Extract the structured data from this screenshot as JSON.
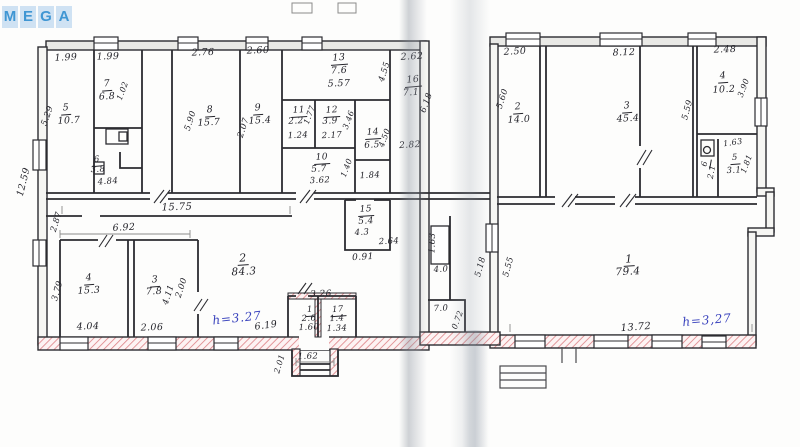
{
  "watermark": {
    "letters": [
      "M",
      "E",
      "G",
      "A"
    ],
    "tile_color": "#cfe2f3",
    "letter_color": "#3f96d3"
  },
  "plan": {
    "ink_color": "#24242b",
    "blue_ink": "#3a43bd",
    "hatch_color": "#dc8084",
    "labels": [
      {
        "id": "dim-199-a",
        "t": "1.99",
        "x": 66,
        "y": 58,
        "r": -3
      },
      {
        "id": "dim-199-b",
        "t": "1.99",
        "x": 108,
        "y": 57,
        "r": -2
      },
      {
        "id": "dim-276",
        "t": "2.76",
        "x": 203,
        "y": 53,
        "r": -2
      },
      {
        "id": "dim-260",
        "t": "2.60",
        "x": 258,
        "y": 51,
        "r": -2
      },
      {
        "id": "room13-num",
        "t": "13",
        "x": 339,
        "y": 59,
        "u": true,
        "r": -4
      },
      {
        "id": "room13-area",
        "t": "7.6",
        "x": 339,
        "y": 71,
        "r": -3
      },
      {
        "id": "dim-557",
        "t": "5.57",
        "x": 339,
        "y": 84,
        "r": -2
      },
      {
        "id": "dim-455",
        "t": "4.55",
        "x": 385,
        "y": 72,
        "r": -72,
        "s": 8.5
      },
      {
        "id": "dim-262",
        "t": "2.62",
        "x": 412,
        "y": 57,
        "r": -3
      },
      {
        "id": "room16-num",
        "t": "16",
        "x": 413,
        "y": 81,
        "u": true,
        "r": -5
      },
      {
        "id": "room16-area",
        "t": "7.1",
        "x": 411,
        "y": 93,
        "r": -3
      },
      {
        "id": "dim-618",
        "t": "6.18",
        "x": 427,
        "y": 103,
        "r": -70,
        "s": 8.5
      },
      {
        "id": "dim-1259",
        "t": "12.59",
        "x": 24,
        "y": 182,
        "r": -76
      },
      {
        "id": "dim-529",
        "t": "5.29",
        "x": 48,
        "y": 116,
        "r": -70,
        "s": 8.5
      },
      {
        "id": "room5-num",
        "t": "5",
        "x": 66,
        "y": 109,
        "u": true,
        "r": -4
      },
      {
        "id": "room5-area",
        "t": "10.7",
        "x": 69,
        "y": 121,
        "r": -3
      },
      {
        "id": "room7-num",
        "t": "7",
        "x": 107,
        "y": 85,
        "u": true,
        "r": -4
      },
      {
        "id": "room7-area",
        "t": "6.8",
        "x": 107,
        "y": 97,
        "r": -3
      },
      {
        "id": "dim-102",
        "t": "1.02",
        "x": 123,
        "y": 91,
        "r": -70,
        "s": 8
      },
      {
        "id": "room6-num",
        "t": "6",
        "x": 97,
        "y": 161,
        "u": true,
        "s": 8.5,
        "r": -5
      },
      {
        "id": "room6-area",
        "t": "3.8",
        "x": 98,
        "y": 170,
        "s": 8.5,
        "r": -3
      },
      {
        "id": "dim-484",
        "t": "4.84",
        "x": 108,
        "y": 182,
        "s": 8.5,
        "r": -4
      },
      {
        "id": "room8-num",
        "t": "8",
        "x": 210,
        "y": 111,
        "u": true,
        "r": -4
      },
      {
        "id": "room8-area",
        "t": "15.7",
        "x": 209,
        "y": 123,
        "r": -3
      },
      {
        "id": "dim-590",
        "t": "5.90",
        "x": 191,
        "y": 121,
        "r": -72,
        "s": 8.5
      },
      {
        "id": "room9-num",
        "t": "9",
        "x": 258,
        "y": 109,
        "u": true,
        "r": -4
      },
      {
        "id": "room9-area",
        "t": "15.4",
        "x": 260,
        "y": 121,
        "r": -3
      },
      {
        "id": "dim-207",
        "t": "2.07",
        "x": 244,
        "y": 128,
        "r": -72,
        "s": 8.5
      },
      {
        "id": "room11-num",
        "t": "11",
        "x": 299,
        "y": 112,
        "u": true,
        "s": 9,
        "r": -4
      },
      {
        "id": "room11-area",
        "t": "2.2",
        "x": 296,
        "y": 122,
        "s": 9,
        "r": -3
      },
      {
        "id": "dim-124",
        "t": "1.24",
        "x": 298,
        "y": 136,
        "s": 8.5,
        "r": -3
      },
      {
        "id": "dim-177",
        "t": "1.77",
        "x": 310,
        "y": 115,
        "r": -70,
        "s": 8
      },
      {
        "id": "room12-num",
        "t": "12",
        "x": 332,
        "y": 112,
        "u": true,
        "s": 9,
        "r": -4
      },
      {
        "id": "room12-area",
        "t": "3.9",
        "x": 330,
        "y": 122,
        "s": 9,
        "r": -3
      },
      {
        "id": "dim-217",
        "t": "2.17",
        "x": 332,
        "y": 136,
        "s": 8.5,
        "r": -3
      },
      {
        "id": "dim-346",
        "t": "3.46",
        "x": 349,
        "y": 120,
        "r": -70,
        "s": 8
      },
      {
        "id": "room14-num",
        "t": "14",
        "x": 373,
        "y": 134,
        "u": true,
        "s": 9,
        "r": -4
      },
      {
        "id": "room14-area",
        "t": "6.5",
        "x": 372,
        "y": 146,
        "s": 9,
        "r": -3
      },
      {
        "id": "dim-450",
        "t": "4.50",
        "x": 385,
        "y": 138,
        "r": -70,
        "s": 8
      },
      {
        "id": "room10-num",
        "t": "10",
        "x": 322,
        "y": 159,
        "u": true,
        "s": 9,
        "r": -4
      },
      {
        "id": "room10-area",
        "t": "5.7",
        "x": 319,
        "y": 170,
        "s": 9,
        "r": -3
      },
      {
        "id": "dim-362",
        "t": "3.62",
        "x": 320,
        "y": 181,
        "s": 8.5,
        "r": -3
      },
      {
        "id": "dim-140",
        "t": "1.40",
        "x": 347,
        "y": 168,
        "r": -70,
        "s": 8
      },
      {
        "id": "dim-184",
        "t": "1.84",
        "x": 370,
        "y": 176,
        "s": 8.5,
        "r": -3
      },
      {
        "id": "dim-282",
        "t": "2.82",
        "x": 410,
        "y": 146,
        "s": 9,
        "r": -3
      },
      {
        "id": "room15-num",
        "t": "15",
        "x": 366,
        "y": 211,
        "u": true,
        "s": 9,
        "r": -4
      },
      {
        "id": "room15-area",
        "t": "5.4",
        "x": 366,
        "y": 222,
        "s": 9,
        "r": -3
      },
      {
        "id": "dim-43",
        "t": "4.3",
        "x": 362,
        "y": 233,
        "s": 8.5,
        "r": -3
      },
      {
        "id": "dim-264",
        "t": "2.64",
        "x": 389,
        "y": 242,
        "s": 8.5,
        "r": -3
      },
      {
        "id": "dim-091",
        "t": "0.91",
        "x": 363,
        "y": 258,
        "s": 9,
        "r": -3
      },
      {
        "id": "dim-1575",
        "t": "15.75",
        "x": 177,
        "y": 208,
        "s": 10,
        "r": -2
      },
      {
        "id": "dim-287",
        "t": "2.87",
        "x": 57,
        "y": 222,
        "r": -73,
        "s": 8.5
      },
      {
        "id": "dim-692",
        "t": "6.92",
        "x": 124,
        "y": 228,
        "s": 9.5,
        "r": -3
      },
      {
        "id": "room4-num",
        "t": "4",
        "x": 89,
        "y": 279,
        "u": true,
        "r": -4
      },
      {
        "id": "room4-area",
        "t": "15.3",
        "x": 89,
        "y": 291,
        "r": -3
      },
      {
        "id": "dim-404",
        "t": "4.04",
        "x": 88,
        "y": 327,
        "r": -2
      },
      {
        "id": "dim-379",
        "t": "3.79",
        "x": 58,
        "y": 291,
        "r": -74,
        "s": 8.5
      },
      {
        "id": "room3-num",
        "t": "3",
        "x": 155,
        "y": 281,
        "u": true,
        "r": -4
      },
      {
        "id": "room3-area",
        "t": "7.8",
        "x": 154,
        "y": 292,
        "r": -3
      },
      {
        "id": "dim-206",
        "t": "2.06",
        "x": 152,
        "y": 328,
        "r": -2
      },
      {
        "id": "dim-411",
        "t": "4.11",
        "x": 169,
        "y": 295,
        "r": -72,
        "s": 8.5
      },
      {
        "id": "dim-200",
        "t": "2.00",
        "x": 182,
        "y": 288,
        "r": -72,
        "s": 8.5
      },
      {
        "id": "room2L-num",
        "t": "2",
        "x": 243,
        "y": 259,
        "u": true,
        "s": 11,
        "r": -4
      },
      {
        "id": "room2L-area",
        "t": "84.3",
        "x": 244,
        "y": 272,
        "s": 10.5,
        "r": -3
      },
      {
        "id": "height-note-left",
        "t": "h=3.27",
        "x": 237,
        "y": 318,
        "blue": true,
        "s": 12,
        "r": -6
      },
      {
        "id": "dim-619",
        "t": "6.19",
        "x": 266,
        "y": 326,
        "r": -8
      },
      {
        "id": "dim-326",
        "t": "3.26",
        "x": 321,
        "y": 295,
        "s": 9,
        "r": -2
      },
      {
        "id": "room1L-num",
        "t": "1",
        "x": 310,
        "y": 311,
        "u": true,
        "s": 8.5,
        "r": -4
      },
      {
        "id": "room1L-area",
        "t": "2.6",
        "x": 309,
        "y": 319,
        "s": 8.5,
        "r": -3
      },
      {
        "id": "dim-160",
        "t": "1.60",
        "x": 309,
        "y": 328,
        "s": 8.5,
        "r": -2
      },
      {
        "id": "room17-num",
        "t": "17",
        "x": 338,
        "y": 311,
        "u": true,
        "s": 8.5,
        "r": -4
      },
      {
        "id": "room17-area",
        "t": "1.4",
        "x": 337,
        "y": 319,
        "s": 8.5,
        "r": -3
      },
      {
        "id": "dim-134",
        "t": "1.34",
        "x": 337,
        "y": 329,
        "s": 8.5,
        "r": -2
      },
      {
        "id": "dim-162",
        "t": "1.62",
        "x": 308,
        "y": 357,
        "s": 8.5,
        "r": -2
      },
      {
        "id": "dim-201",
        "t": "2.01",
        "x": 280,
        "y": 364,
        "r": -73,
        "s": 8
      },
      {
        "id": "dim-163-mid",
        "t": "1.63",
        "x": 433,
        "y": 243,
        "r": -88,
        "s": 8.5
      },
      {
        "id": "dim-40",
        "t": "4.0",
        "x": 441,
        "y": 270,
        "s": 8.5,
        "r": -3
      },
      {
        "id": "dim-518",
        "t": "5.18",
        "x": 481,
        "y": 267,
        "r": -75,
        "s": 8.5
      },
      {
        "id": "dim-555-a",
        "t": "5.55",
        "x": 509,
        "y": 267,
        "r": -75,
        "s": 8.5
      },
      {
        "id": "dim-70",
        "t": "7.0",
        "x": 441,
        "y": 309,
        "s": 8.5,
        "r": -3
      },
      {
        "id": "dim-072",
        "t": "0.72",
        "x": 458,
        "y": 320,
        "r": -70,
        "s": 8
      },
      {
        "id": "dim-250",
        "t": "2.50",
        "x": 515,
        "y": 52,
        "r": -3
      },
      {
        "id": "dim-812",
        "t": "8.12",
        "x": 624,
        "y": 53,
        "r": -2
      },
      {
        "id": "dim-248",
        "t": "2.48",
        "x": 725,
        "y": 50,
        "r": -2
      },
      {
        "id": "room2R-num",
        "t": "2",
        "x": 518,
        "y": 108,
        "u": true,
        "r": -4
      },
      {
        "id": "room2R-area",
        "t": "14.0",
        "x": 519,
        "y": 120,
        "r": -3
      },
      {
        "id": "dim-560",
        "t": "5.60",
        "x": 503,
        "y": 99,
        "r": -72,
        "s": 8.5
      },
      {
        "id": "room3R-num",
        "t": "3",
        "x": 627,
        "y": 107,
        "u": true,
        "r": -4
      },
      {
        "id": "room3R-area",
        "t": "45.4",
        "x": 628,
        "y": 119,
        "r": -3
      },
      {
        "id": "dim-559",
        "t": "5.59",
        "x": 688,
        "y": 110,
        "r": -75,
        "s": 8.5
      },
      {
        "id": "room4R-num",
        "t": "4",
        "x": 723,
        "y": 77,
        "u": true,
        "r": -4
      },
      {
        "id": "room4R-area",
        "t": "10.2",
        "x": 724,
        "y": 90,
        "r": -3
      },
      {
        "id": "dim-390",
        "t": "3.90",
        "x": 744,
        "y": 88,
        "r": -70,
        "s": 8
      },
      {
        "id": "dim-163-r",
        "t": "1.63",
        "x": 733,
        "y": 143,
        "s": 8,
        "r": -8
      },
      {
        "id": "room5R-num",
        "t": "5",
        "x": 735,
        "y": 159,
        "u": true,
        "s": 8.5,
        "r": -4
      },
      {
        "id": "room5R-area",
        "t": "3.1",
        "x": 734,
        "y": 171,
        "s": 8.5,
        "r": -3
      },
      {
        "id": "dim-181",
        "t": "1.81",
        "x": 747,
        "y": 164,
        "r": -70,
        "s": 8
      },
      {
        "id": "room6R-num",
        "t": "6",
        "x": 706,
        "y": 164,
        "u": true,
        "s": 8,
        "r": -80
      },
      {
        "id": "room6R-area",
        "t": "2.1",
        "x": 712,
        "y": 172,
        "s": 8,
        "r": -80
      },
      {
        "id": "room1R-num",
        "t": "1",
        "x": 629,
        "y": 260,
        "u": true,
        "s": 11,
        "r": -4
      },
      {
        "id": "room1R-area",
        "t": "79.4",
        "x": 628,
        "y": 272,
        "s": 10.5,
        "r": -3
      },
      {
        "id": "dim-1372",
        "t": "13.72",
        "x": 636,
        "y": 328,
        "s": 10,
        "r": -4
      },
      {
        "id": "height-note-right",
        "t": "h=3,27",
        "x": 707,
        "y": 320,
        "blue": true,
        "s": 12,
        "r": -5
      }
    ]
  }
}
